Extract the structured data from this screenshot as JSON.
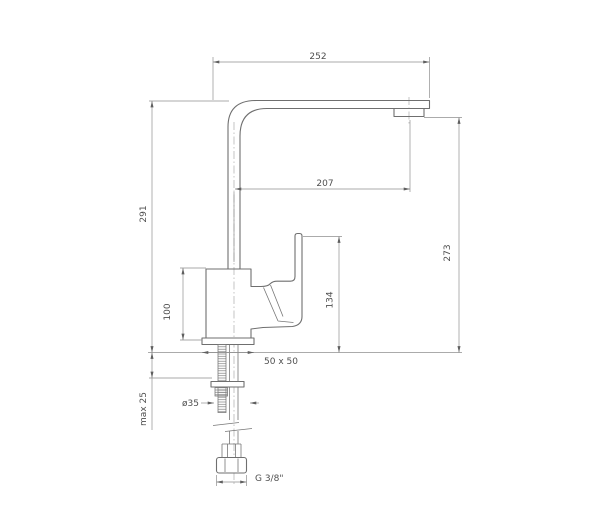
{
  "drawing": {
    "object": "single-lever kitchen sink mixer tap, side elevation with installation dimensions",
    "units": "mm",
    "labels": {
      "spout_span_top": "252",
      "spout_reach_to_aerator": "207",
      "height_to_spout_top": "291",
      "height_to_aerator_outlet": "273",
      "height_to_handle_top": "134",
      "body_height": "100",
      "base_footprint": "50 x 50",
      "mounting_hole_diameter": "ø35",
      "max_deck_thickness": "max 25",
      "supply_connection": "G 3/8\""
    },
    "colors": {
      "outline": "#6f6f6f",
      "dimension_lines": "#8f8f8f",
      "text": "#4f4f4f",
      "background": "#ffffff"
    }
  }
}
